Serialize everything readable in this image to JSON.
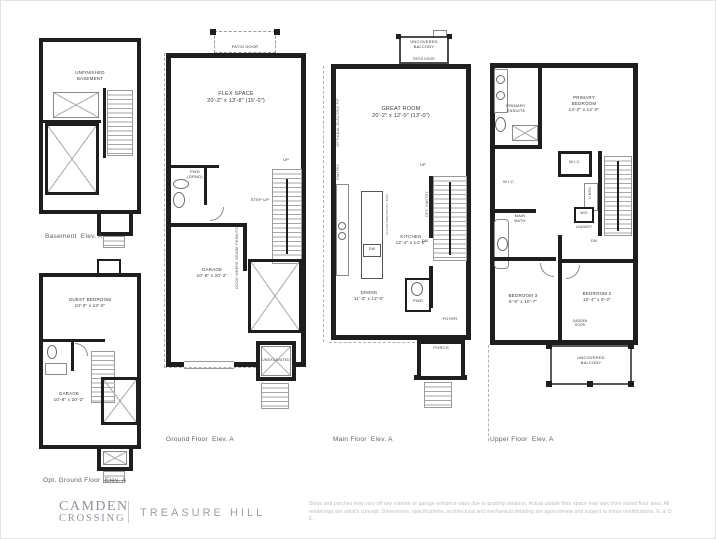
{
  "plans": {
    "basement": {
      "caption": "Basement  Elev. A",
      "room": "UNFINISHED\nBASEMENT"
    },
    "opt_ground": {
      "caption": "Opt. Ground Floor  Elev. A",
      "guest": "GUEST BEDROOM\n10'-0\" x 13'-0\"",
      "garage": "GARAGE\n10'-8\" x 20'-2\""
    },
    "ground": {
      "caption": "Ground Floor  Elev. A",
      "patio_door": "PATIO DOOR",
      "flex": "FLEX SPACE\n20'-2\" x 13'-8\" (15'-0\")",
      "pwd": "PWD\n(GRND)",
      "step_up": "STEP UP",
      "up": "UP",
      "garage": "GARAGE\n10'-8\" x 20'-2\"",
      "unexcavated": "UNEXCAVATED",
      "door_note": "DOOR WHERE GRADE PERMITS"
    },
    "main": {
      "caption": "Main Floor  Elev. A",
      "balcony": "UNCOVERED\nBALCONY",
      "patio_door": "PATIO DOOR",
      "great_room": "GREAT ROOM\n20'-2\" x 12'-0\" (13'-0\")",
      "fireplace_note": "OPTIONAL ELECTRIC F/P",
      "pantry": "PANTRY",
      "opt_pantry": "OPT. PANTRY",
      "kitchen": "KITCHEN\n12'-4\" x 14'-0\"",
      "dw": "DW",
      "breakfast_bar": "FLUSH BREAKFAST BAR",
      "dining": "DINING\n11'-3\" x 12'-0\"",
      "pwd": "PWD",
      "foyer": "FOYER",
      "porch": "PORCH",
      "up": "UP",
      "dn": "DN"
    },
    "upper": {
      "caption": "Upper Floor  Elev. A",
      "ensuite": "PRIMARY\nENSUITE",
      "primary": "PRIMARY\nBEDROOM\n14'-0\" x 12'-0\"",
      "wic1": "W.I.C.",
      "wic2": "W.I.C.",
      "main_bath": "MAIN\nBATH",
      "linen": "LINEN",
      "wd": "W/D",
      "laundry": "LAUNDRY",
      "bedroom3": "BEDROOM 3\n9'-6\" x 10'-7\"",
      "bedroom2": "BEDROOM 2\n10'-4\" x 9'-2\"",
      "garden_door": "GARDEN\nDOOR",
      "balcony": "UNCOVERED\nBALCONY",
      "dn": "DN"
    }
  },
  "footer": {
    "brand_line1": "CAMDEN",
    "brand_line2": "CROSSING",
    "builder": "TREASURE HILL",
    "disclaimer": "Steps and porches may vary off any exterior or garage entrance ways due to grading variance. Actual usable floor space may vary from stated floor area. All renderings are artist's concept. Dimensions, specifications, architectural and mechanical detailing are approximate and subject to minor modifications. E. & O. E."
  },
  "colors": {
    "wall": "#1e1e1e",
    "brand_gray": "#8e939b",
    "caption_gray": "#5f5f5f"
  }
}
